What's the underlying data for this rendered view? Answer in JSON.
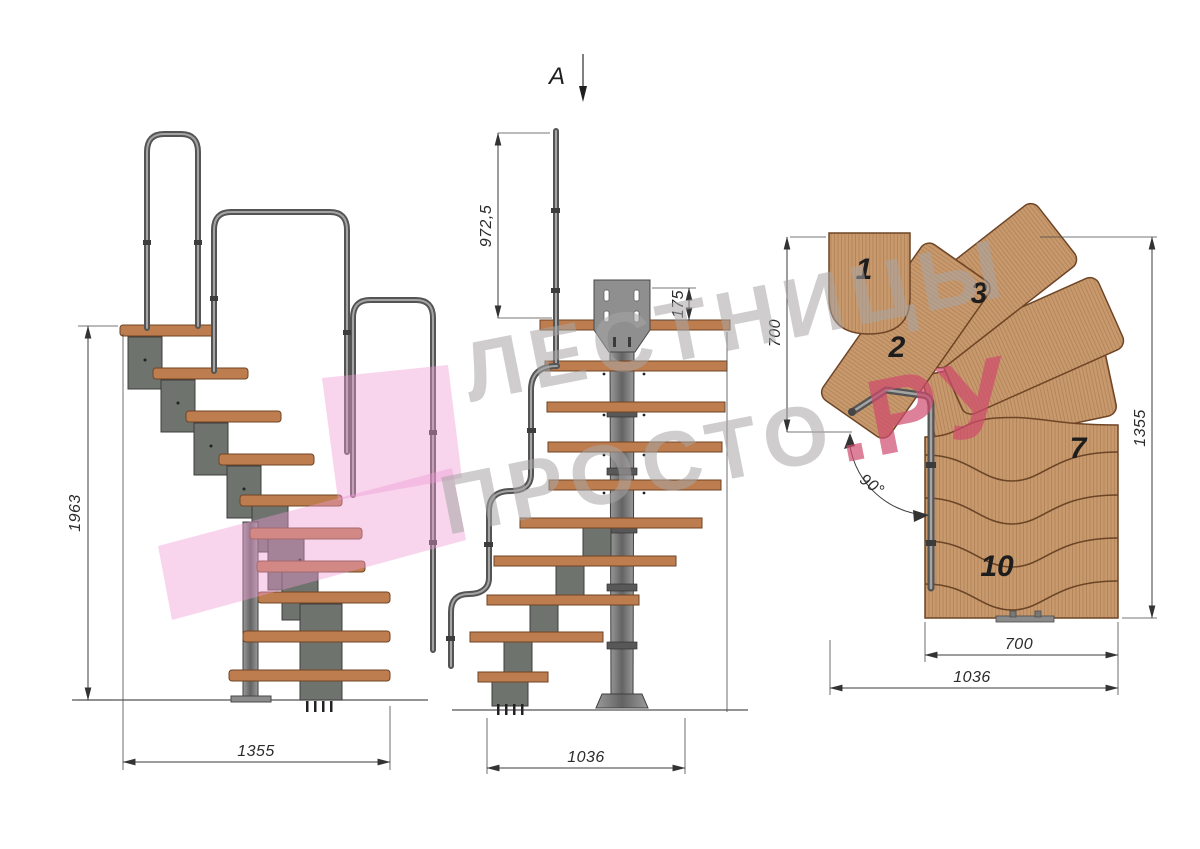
{
  "watermark": {
    "line1": "ЛЕСТНИЦЫ",
    "line2_gray": "ПРОСТО",
    "line2_pink": ".РУ"
  },
  "section_marker": {
    "label": "A"
  },
  "side_view": {
    "dims": {
      "height": "1963",
      "width": "1355"
    }
  },
  "front_view": {
    "dims": {
      "rail_height": "972,5",
      "plate_offset": "175",
      "width": "1036"
    }
  },
  "plan_view": {
    "dims": {
      "upper_run": "700",
      "total_depth": "1355",
      "flight_width": "700",
      "total_width": "1036",
      "turn_angle": "90°"
    },
    "step_numbers": [
      "1",
      "2",
      "3",
      "7",
      "10"
    ]
  },
  "colors": {
    "wood_side": "#bd7d4f",
    "wood_dark_edge": "#6f4526",
    "wood_plan": "#c8996c",
    "metal": "#787878",
    "module": "#6f736e",
    "line": "#3b3b3b",
    "watermark_gray": "#a8a6a6",
    "watermark_pink": "#d04b6e",
    "logo_pink": "#ef9cd4"
  }
}
